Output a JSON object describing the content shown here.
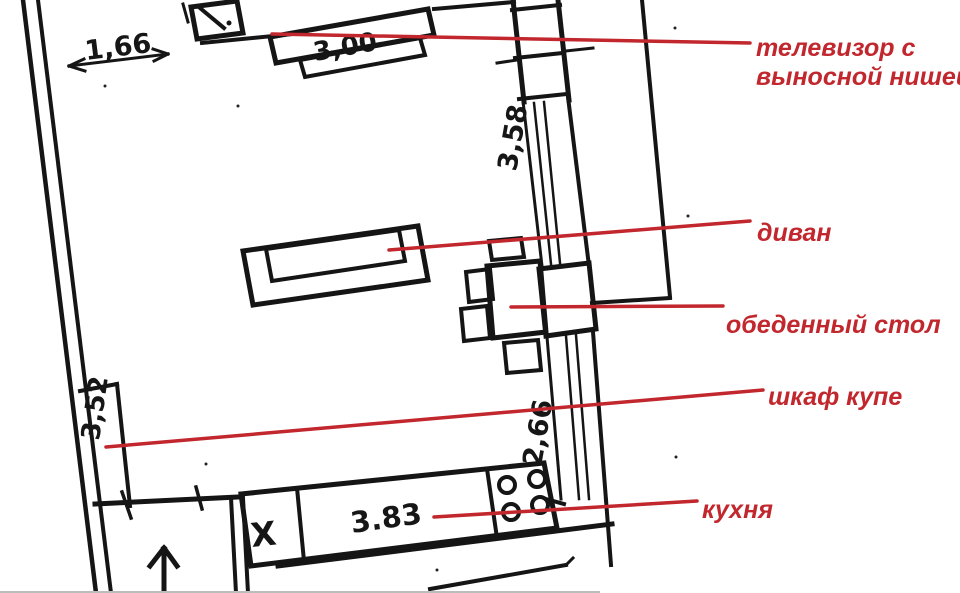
{
  "figure": {
    "kind": "hand-drawn apartment floor plan sketch with red annotation callouts",
    "background_color": "#ffffff",
    "ink_color": "#151515",
    "annotation_color": "#c1272d"
  },
  "dimensions": {
    "entry_width": "1,66",
    "tv_wall_width": "3,00",
    "window_wall_upper": "3,58",
    "left_wall_segment": "3,52",
    "window_wall_lower": "2,66",
    "kitchen_counter_width": "3.83"
  },
  "marks": {
    "sink_cross": "X"
  },
  "labels": {
    "tv_line1": "телевизор с",
    "tv_line2": "выносной нишей",
    "sofa": "диван",
    "dining_table": "обеденный стол",
    "wardrobe": "шкаф купе",
    "kitchen": "кухня"
  }
}
